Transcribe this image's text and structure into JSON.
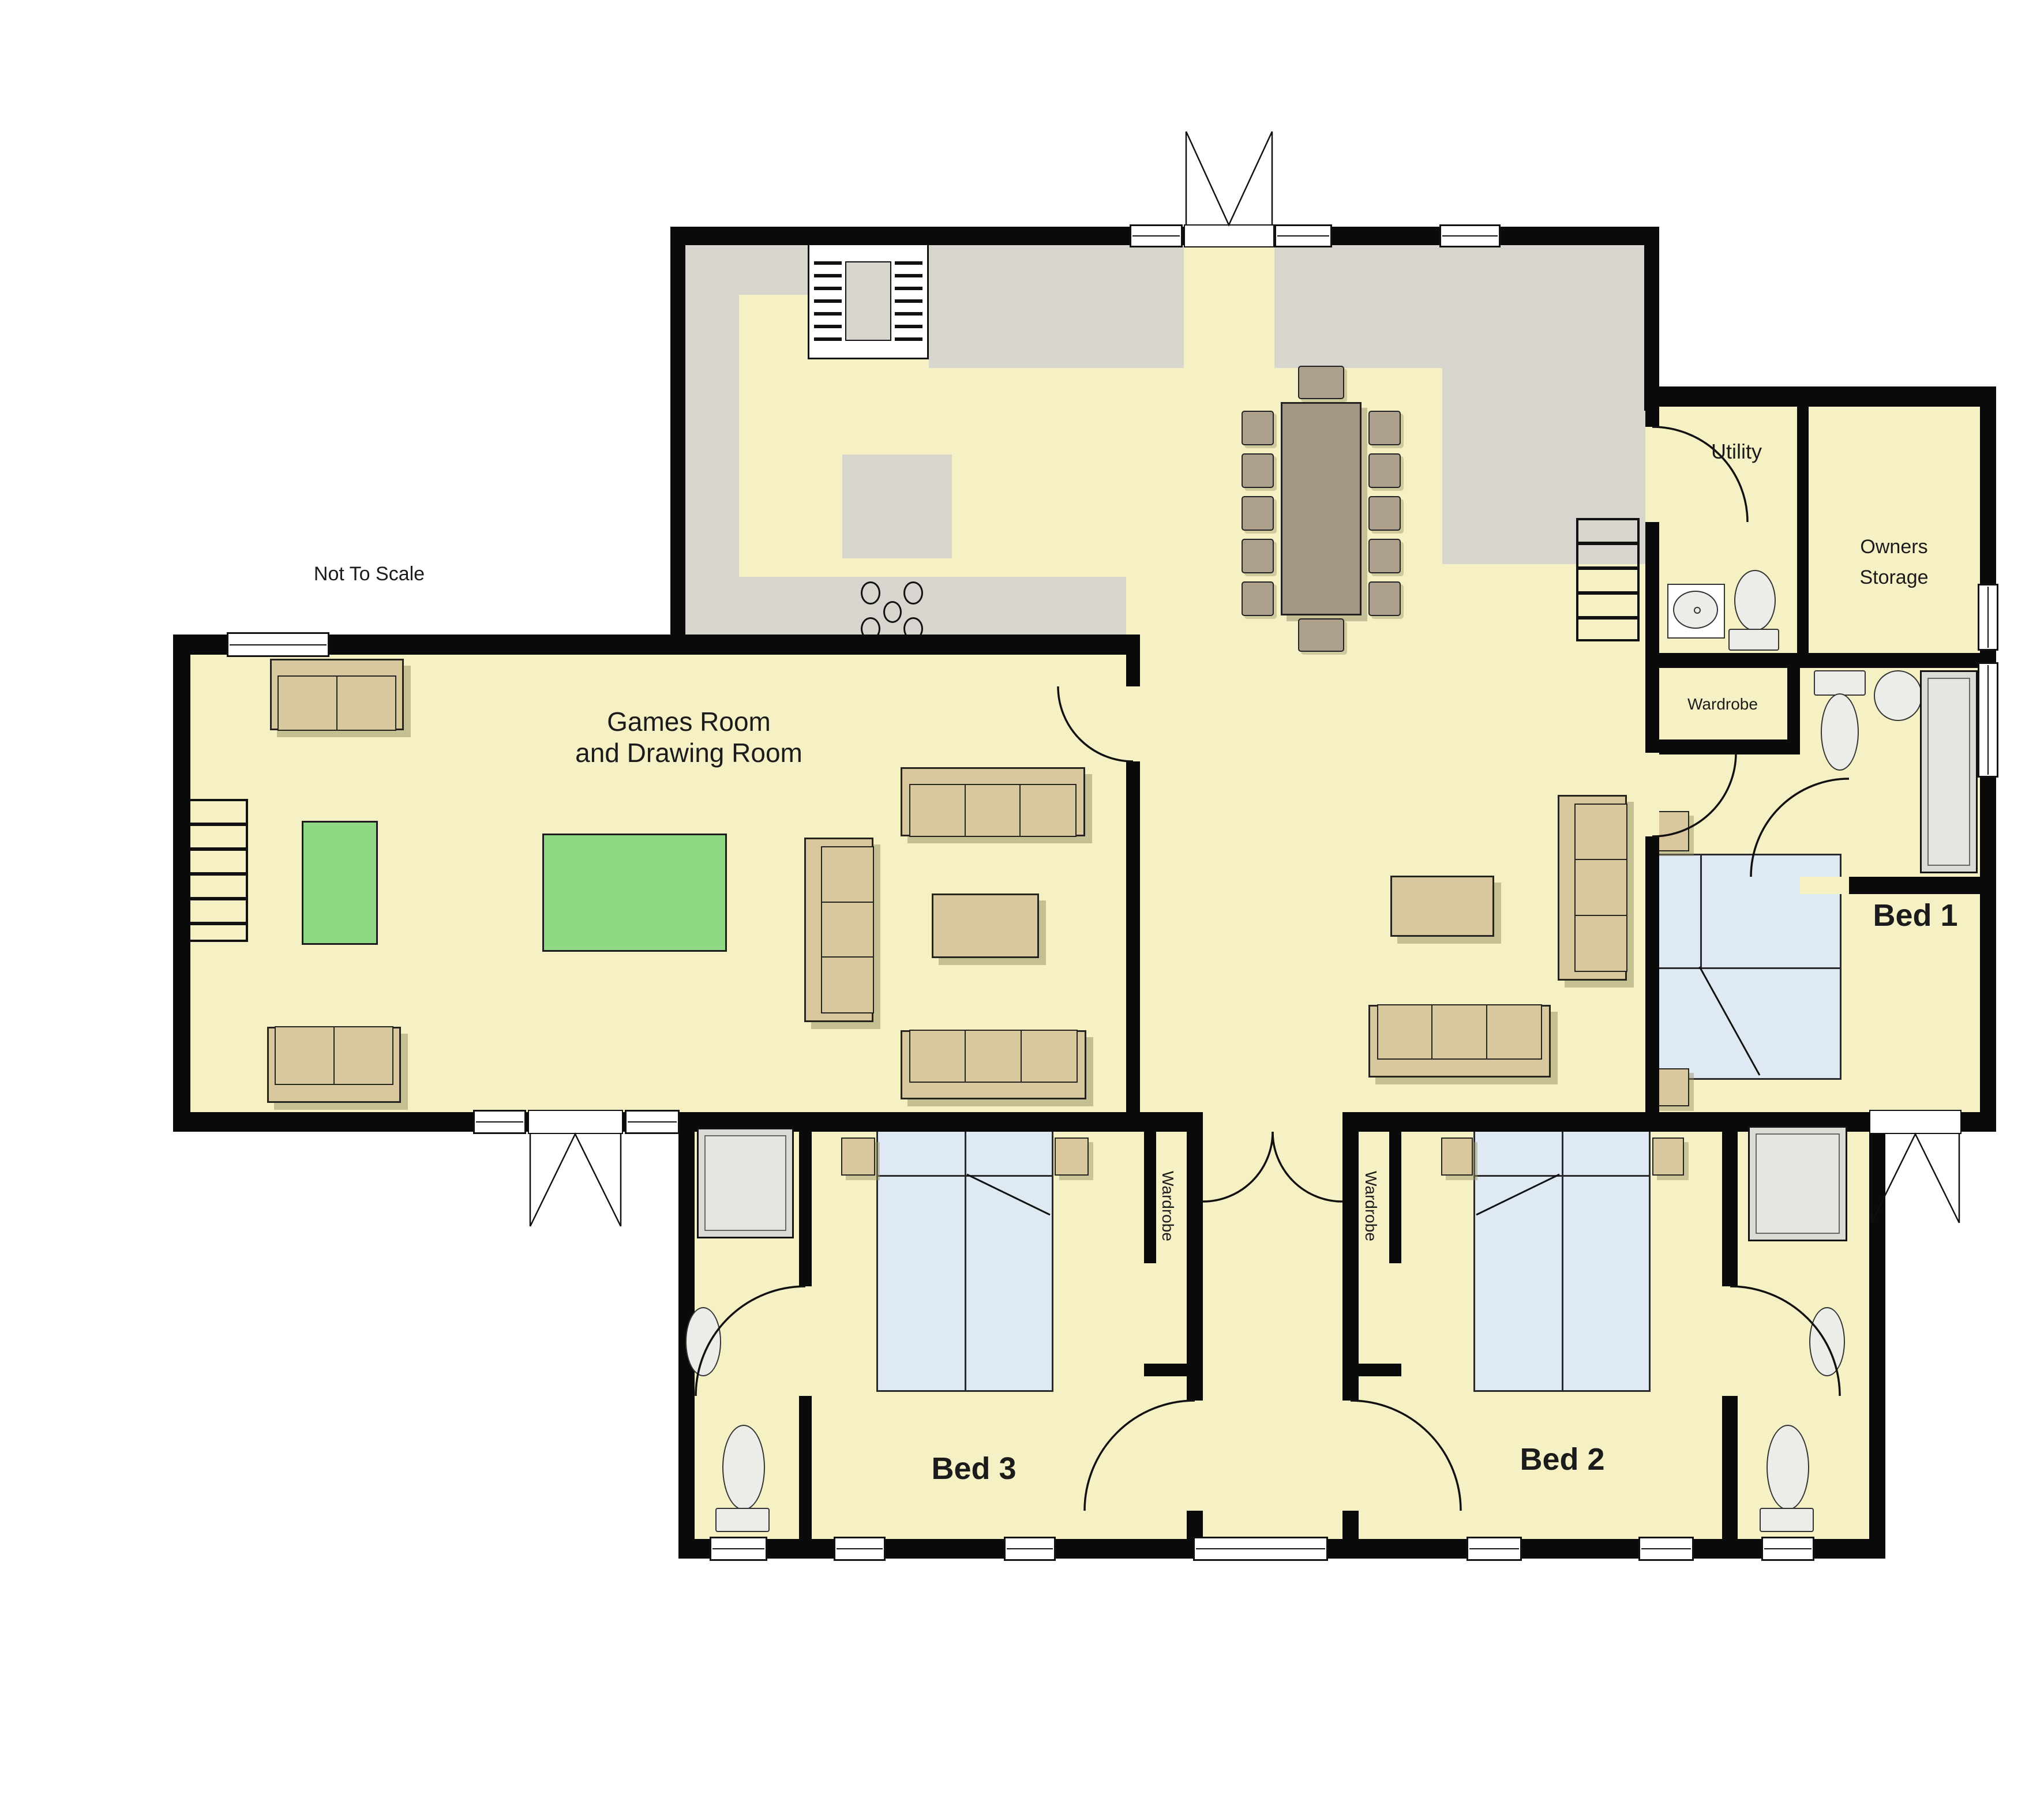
{
  "plan": {
    "scale_note": "Not To Scale",
    "labels": {
      "games_line1": "Games Room",
      "games_line2": "and Drawing Room",
      "utility": "Utility",
      "storage_line1": "Owners",
      "storage_line2": "Storage",
      "wardrobe_bed1": "Wardrobe",
      "wardrobe_bed3": "Wardrobe",
      "wardrobe_bed2": "Wardrobe",
      "bed1": "Bed 1",
      "bed2": "Bed 2",
      "bed3": "Bed 3"
    },
    "colors": {
      "floor": "#f5f1c5",
      "wall": "#0a0a0a",
      "counter": "#d7d5cd",
      "green": "#8fd984",
      "sofa": "#d9c89e",
      "bed": "#dee9f3",
      "wood": "#a39685",
      "fixture": "#ecece8",
      "shadow": "#c9c3a4"
    }
  }
}
